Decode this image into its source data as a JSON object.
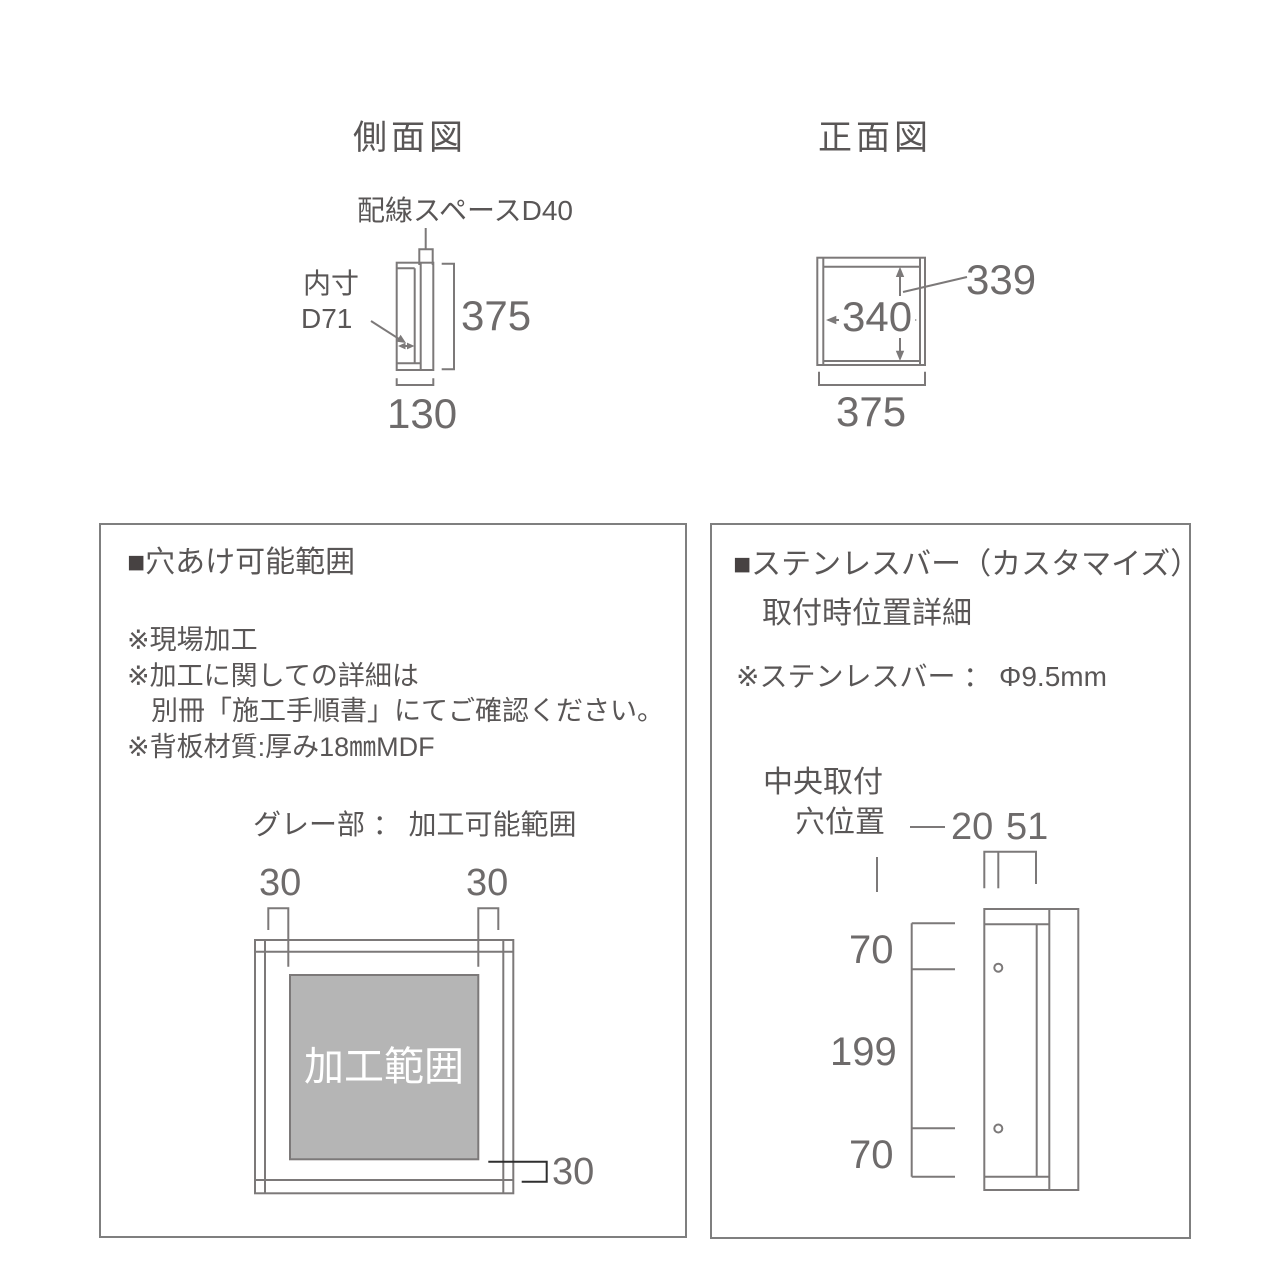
{
  "titles": {
    "side_view": "側面図",
    "front_view": "正面図"
  },
  "side_view": {
    "wiring_label": "配線スペースD40",
    "inner_depth_line1": "内寸",
    "inner_depth_line2": "D71",
    "height_dim": "375",
    "depth_dim": "130"
  },
  "front_view": {
    "inner_height_dim": "339",
    "inner_width_dim": "340",
    "width_dim": "375"
  },
  "left_panel": {
    "bullet": "■",
    "heading": "穴あけ可能範囲",
    "notes": [
      "※現場加工",
      "※加工に関しての詳細は",
      "別冊「施工手順書」にてご確認ください。",
      "※背板材質:厚み18㎜MDF"
    ],
    "legend": "グレー部 ： 加工可能範囲",
    "dim_top_left": "30",
    "dim_top_right": "30",
    "dim_bottom": "30",
    "gray_area_label": "加工範囲"
  },
  "right_panel": {
    "bullet": "■",
    "heading": "ステンレスバー（カスタマイズ）",
    "subheading": "取付時位置詳細",
    "note": "※ステンレスバー ： Φ9.5mm",
    "hole_label_line1": "中央取付",
    "hole_label_line2": "穴位置",
    "dim_left_offset": "20",
    "dim_right_offset": "51",
    "dim_top": "70",
    "dim_middle": "199",
    "dim_bottom": "70"
  },
  "colors": {
    "line": "#7c7979",
    "text": "#595656",
    "dimnum": "#6e6b6b",
    "bullet": "#474242",
    "gray_fill": "#b5b5b5",
    "panel_border": "#7f7f7f",
    "dark_line": "#2f2f2f"
  }
}
